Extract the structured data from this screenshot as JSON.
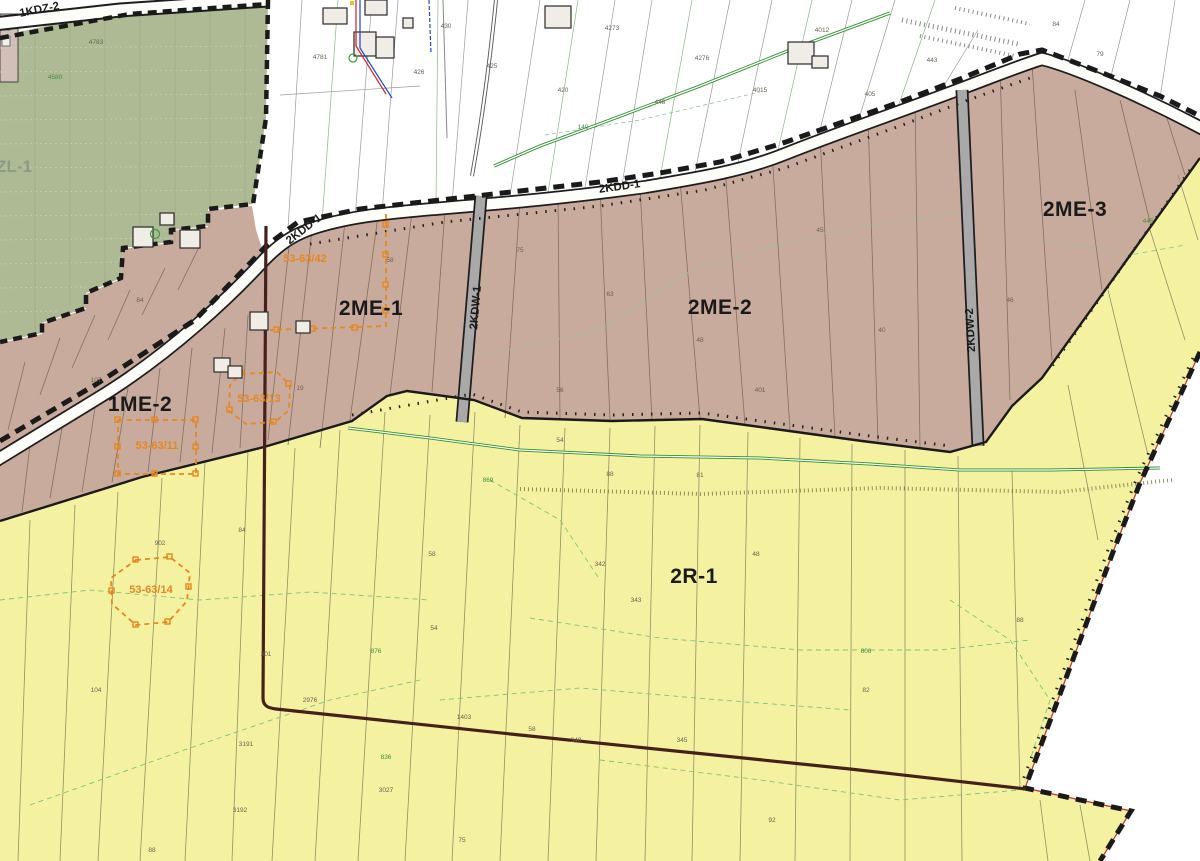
{
  "map": {
    "type": "municipal-zoning-plan-map",
    "colors": {
      "forest": "#aeba94",
      "residential": "#c9ab9d",
      "farmland": "#f4f2a1",
      "road_fill": "#fdfdfa",
      "kdw_fill": "#a9a9a9",
      "boundary": "#1a1a1a",
      "precinct_line": "#46201b",
      "heritage": "#e8861f",
      "drain_green": "#2f8f2f",
      "dash_green": "#7cc47c",
      "label_dark": "#1a1a1a",
      "label_forest": "#8d9a85",
      "tiny_green": "#3f8f3f",
      "red_line": "#c03b2d"
    }
  },
  "zone_labels": [
    {
      "name": "zone-label-zl-1",
      "text": "ZL-1",
      "x": 14,
      "y": 172,
      "rot": 0,
      "cls": "zl"
    },
    {
      "name": "zone-label-1me-2",
      "text": "1ME-2",
      "x": 140,
      "y": 411,
      "rot": 0,
      "cls": "zone"
    },
    {
      "name": "zone-label-2me-1",
      "text": "2ME-1",
      "x": 371,
      "y": 315,
      "rot": 0,
      "cls": "zone"
    },
    {
      "name": "zone-label-2me-2",
      "text": "2ME-2",
      "x": 720,
      "y": 314,
      "rot": 0,
      "cls": "zone"
    },
    {
      "name": "zone-label-2me-3",
      "text": "2ME-3",
      "x": 1075,
      "y": 216,
      "rot": 0,
      "cls": "zone"
    },
    {
      "name": "zone-label-2r-1",
      "text": "2R-1",
      "x": 694,
      "y": 583,
      "rot": 0,
      "cls": "zone"
    }
  ],
  "road_labels": [
    {
      "name": "road-label-1kdz-2",
      "text": "1KDZ-2",
      "x": 40,
      "y": 13,
      "rot": -11
    },
    {
      "name": "road-label-2kdd-1-west",
      "text": "2KDD-1",
      "x": 306,
      "y": 232,
      "rot": -38
    },
    {
      "name": "road-label-2kdd-1-east",
      "text": "2KDD-1",
      "x": 620,
      "y": 190,
      "rot": -8
    },
    {
      "name": "road-label-2kdw-1",
      "text": "2KDW-1",
      "x": 479,
      "y": 308,
      "rot": -85
    },
    {
      "name": "road-label-2kdw-2",
      "text": "2KDW-2",
      "x": 974,
      "y": 330,
      "rot": -93
    }
  ],
  "heritage_labels": [
    {
      "name": "heritage-label-53-63-42",
      "text": "53-63/42",
      "x": 305,
      "y": 262,
      "rot": 0
    },
    {
      "name": "heritage-label-53-63-13",
      "text": "53-63/13",
      "x": 259,
      "y": 402,
      "rot": 0
    },
    {
      "name": "heritage-label-53-63-11",
      "text": "53-63/11",
      "x": 157,
      "y": 449,
      "rot": 0
    },
    {
      "name": "heritage-label-53-63-14",
      "text": "53-63/14",
      "x": 151,
      "y": 593,
      "rot": 0
    }
  ],
  "parcel_numbers": [
    {
      "t": "4783",
      "x": 96,
      "y": 44
    },
    {
      "t": "4781",
      "x": 320,
      "y": 59
    },
    {
      "t": "426",
      "x": 419,
      "y": 74
    },
    {
      "t": "430",
      "x": 446,
      "y": 28
    },
    {
      "t": "425",
      "x": 492,
      "y": 68
    },
    {
      "t": "4273",
      "x": 612,
      "y": 30
    },
    {
      "t": "420",
      "x": 563,
      "y": 92
    },
    {
      "t": "448",
      "x": 660,
      "y": 104
    },
    {
      "t": "4276",
      "x": 702,
      "y": 60
    },
    {
      "t": "4015",
      "x": 760,
      "y": 92
    },
    {
      "t": "4012",
      "x": 822,
      "y": 32
    },
    {
      "t": "405",
      "x": 870,
      "y": 96
    },
    {
      "t": "443",
      "x": 932,
      "y": 62
    },
    {
      "t": "84",
      "x": 1056,
      "y": 26
    },
    {
      "t": "79",
      "x": 1100,
      "y": 56
    },
    {
      "t": "4580",
      "x": 55,
      "y": 79,
      "g": 1
    },
    {
      "t": "140",
      "x": 583,
      "y": 129,
      "g": 1
    },
    {
      "t": "58",
      "x": 390,
      "y": 262
    },
    {
      "t": "75",
      "x": 520,
      "y": 252
    },
    {
      "t": "63",
      "x": 610,
      "y": 296
    },
    {
      "t": "48",
      "x": 700,
      "y": 342
    },
    {
      "t": "45",
      "x": 820,
      "y": 232
    },
    {
      "t": "40",
      "x": 882,
      "y": 332
    },
    {
      "t": "46",
      "x": 1010,
      "y": 302
    },
    {
      "t": "401",
      "x": 760,
      "y": 392
    },
    {
      "t": "56",
      "x": 560,
      "y": 392
    },
    {
      "t": "84",
      "x": 140,
      "y": 302
    },
    {
      "t": "107",
      "x": 96,
      "y": 382
    },
    {
      "t": "19",
      "x": 300,
      "y": 390
    },
    {
      "t": "902",
      "x": 160,
      "y": 545
    },
    {
      "t": "84",
      "x": 242,
      "y": 532
    },
    {
      "t": "58",
      "x": 432,
      "y": 556
    },
    {
      "t": "54",
      "x": 560,
      "y": 442
    },
    {
      "t": "88",
      "x": 610,
      "y": 476
    },
    {
      "t": "81",
      "x": 700,
      "y": 477
    },
    {
      "t": "48",
      "x": 756,
      "y": 556
    },
    {
      "t": "343",
      "x": 636,
      "y": 602
    },
    {
      "t": "342",
      "x": 600,
      "y": 566
    },
    {
      "t": "54",
      "x": 434,
      "y": 630
    },
    {
      "t": "1403",
      "x": 464,
      "y": 719
    },
    {
      "t": "58",
      "x": 532,
      "y": 731
    },
    {
      "t": "340",
      "x": 576,
      "y": 742
    },
    {
      "t": "345",
      "x": 682,
      "y": 742
    },
    {
      "t": "2976",
      "x": 310,
      "y": 702
    },
    {
      "t": "3027",
      "x": 386,
      "y": 792
    },
    {
      "t": "3191",
      "x": 246,
      "y": 746
    },
    {
      "t": "3192",
      "x": 240,
      "y": 812
    },
    {
      "t": "104",
      "x": 96,
      "y": 692
    },
    {
      "t": "301",
      "x": 266,
      "y": 656
    },
    {
      "t": "82",
      "x": 866,
      "y": 692
    },
    {
      "t": "88",
      "x": 1020,
      "y": 622
    },
    {
      "t": "92",
      "x": 772,
      "y": 822
    },
    {
      "t": "75",
      "x": 462,
      "y": 842
    },
    {
      "t": "88",
      "x": 152,
      "y": 852
    },
    {
      "t": "876",
      "x": 376,
      "y": 653,
      "g": 1
    },
    {
      "t": "836",
      "x": 386,
      "y": 759,
      "g": 1
    },
    {
      "t": "806",
      "x": 866,
      "y": 653,
      "g": 1
    },
    {
      "t": "869",
      "x": 488,
      "y": 482,
      "g": 1
    },
    {
      "t": "445",
      "x": 1148,
      "y": 223,
      "g": 1
    }
  ]
}
